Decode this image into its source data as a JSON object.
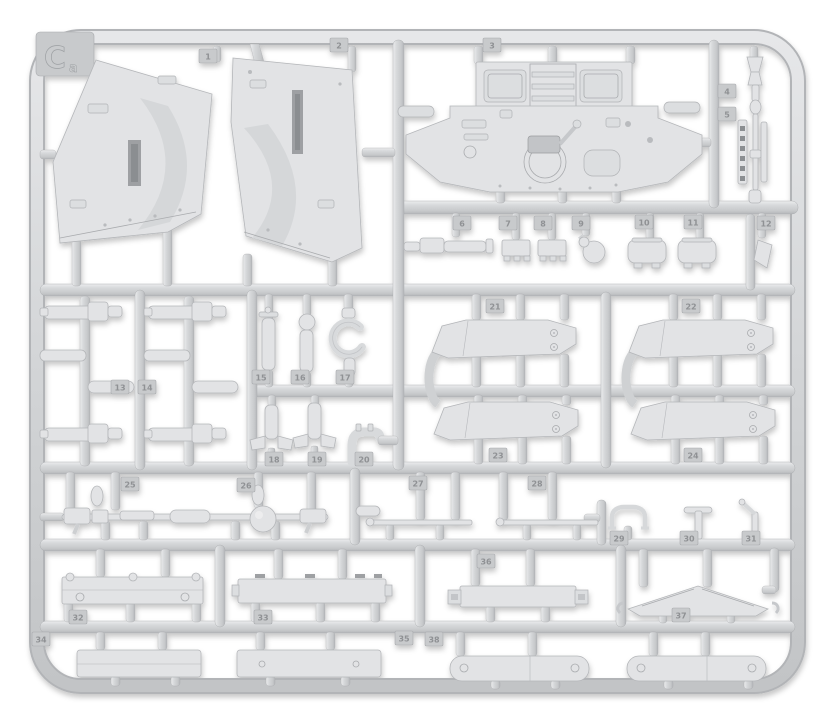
{
  "scene": {
    "type": "photograph",
    "subject": "injection-molded plastic model kit sprue (runner frame) with unpainted light gray parts",
    "background_color": "#ffffff",
    "plastic_color": "#d9dadc"
  },
  "sprue": {
    "corner_letter": "C",
    "corner_letter_sub": "a",
    "tabs": [
      "1",
      "2",
      "3",
      "4",
      "5",
      "6",
      "7",
      "8",
      "9",
      "10",
      "11",
      "12",
      "13",
      "14",
      "15",
      "16",
      "17",
      "18",
      "19",
      "20",
      "21",
      "22",
      "23",
      "24",
      "25",
      "26",
      "27",
      "28",
      "29",
      "30",
      "31",
      "32",
      "33",
      "34",
      "35",
      "36",
      "37",
      "38"
    ]
  }
}
